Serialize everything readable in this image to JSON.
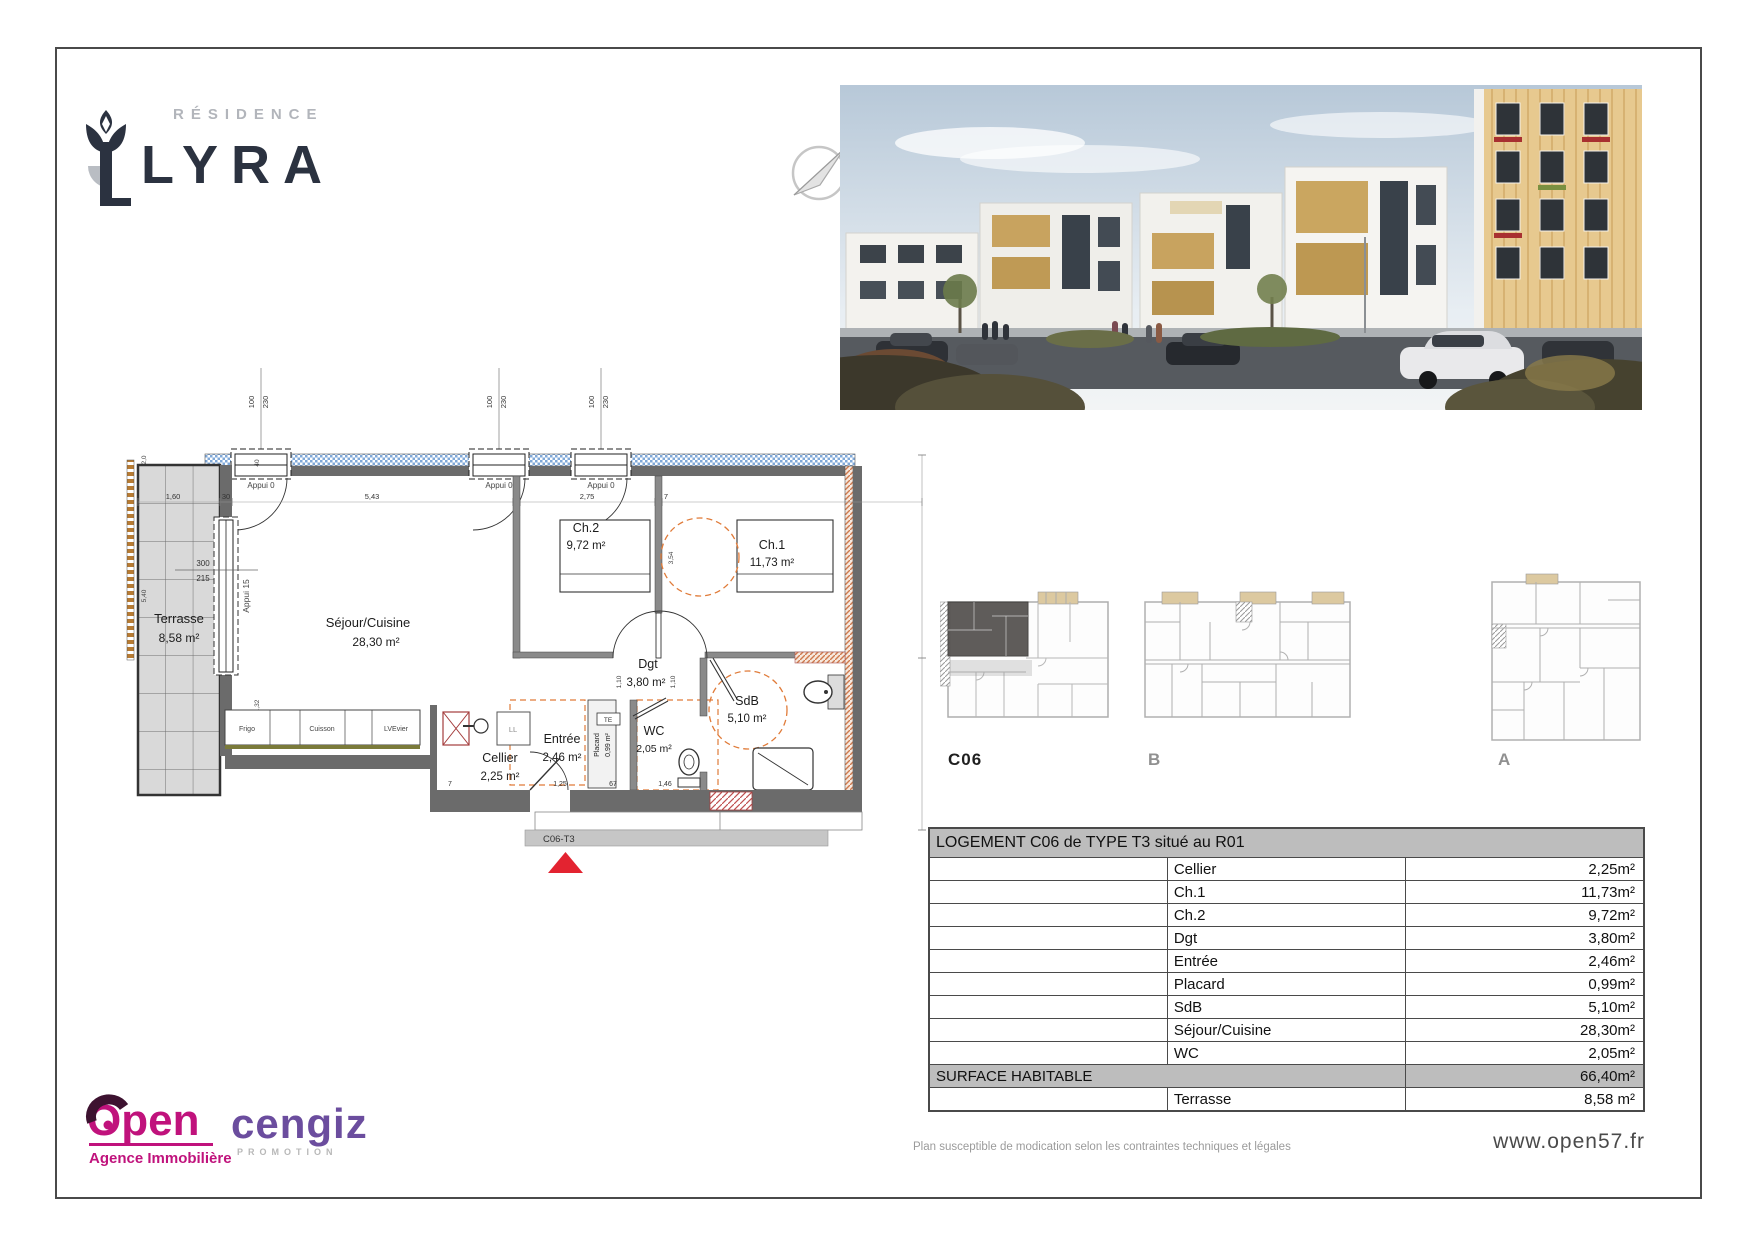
{
  "brand": {
    "residence_label": "RÉSIDENCE",
    "name": "LYRA"
  },
  "plan": {
    "unit_label": "C06-T3",
    "rooms": {
      "terrasse": {
        "name": "Terrasse",
        "area": "8,58 m²"
      },
      "sejour": {
        "name": "Séjour/Cuisine",
        "area": "28,30 m²"
      },
      "ch2": {
        "name": "Ch.2",
        "area": "9,72 m²"
      },
      "ch1": {
        "name": "Ch.1",
        "area": "11,73 m²"
      },
      "dgt": {
        "name": "Dgt",
        "area": "3,80 m²"
      },
      "sdb": {
        "name": "SdB",
        "area": "5,10 m²"
      },
      "wc": {
        "name": "WC",
        "area": "2,05 m²"
      },
      "entree": {
        "name": "Entrée",
        "area": "2,46 m²"
      },
      "cellier": {
        "name": "Cellier",
        "area": "2,25 m²"
      },
      "placard": {
        "name": "Placard",
        "area": "0,99 m²"
      }
    },
    "labels": {
      "appui0": "Appui 0",
      "appui15": "Appui 15",
      "frigo": "Frigo",
      "cuisson": "Cuisson",
      "evier": "LVEvier",
      "ll": "LL",
      "te": "TE"
    },
    "dims": {
      "w100": "100",
      "h230": "230",
      "d300": "300",
      "d215": "215",
      "t160": "1,60",
      "t30": "30",
      "t543": "5,43",
      "t275": "2,75",
      "t7": "7",
      "v354": "3,54",
      "v110": "1,10",
      "v40": "40",
      "v20": "2,0",
      "v540": "5,40",
      "v132": "1,32",
      "b125": "1,25",
      "b67": "67",
      "b146": "1,46"
    }
  },
  "mini_plans": {
    "labels": [
      "C06",
      "B",
      "A"
    ]
  },
  "table": {
    "title": "LOGEMENT C06 de TYPE T3 situé au R01",
    "rows": [
      {
        "label": "Cellier",
        "value": "2,25m²"
      },
      {
        "label": "Ch.1",
        "value": "11,73m²"
      },
      {
        "label": "Ch.2",
        "value": "9,72m²"
      },
      {
        "label": "Dgt",
        "value": "3,80m²"
      },
      {
        "label": "Entrée",
        "value": "2,46m²"
      },
      {
        "label": "Placard",
        "value": "0,99m²"
      },
      {
        "label": "SdB",
        "value": "5,10m²"
      },
      {
        "label": "Séjour/Cuisine",
        "value": "28,30m²"
      },
      {
        "label": "WC",
        "value": "2,05m²"
      }
    ],
    "surface": {
      "label": "SURFACE HABITABLE",
      "value": "66,40m²"
    },
    "annex": {
      "label": "Terrasse",
      "value": "8,58 m²"
    }
  },
  "logos": {
    "open": {
      "name": "Open",
      "tagline": "Agence Immobilière"
    },
    "cengiz": {
      "name": "cengiz",
      "tagline": "PROMOTION"
    }
  },
  "footer": {
    "disclaimer": "Plan susceptible de modication selon les contraintes techniques et légales",
    "website": "www.open57.fr"
  },
  "colors": {
    "accent_magenta": "#c0127c",
    "accent_purple": "#6b4d9e",
    "navy": "#2b3240",
    "table_header_bg": "#bdbdbd",
    "wall": "#6b6b6b",
    "hatch_blue": "#7fa8d9",
    "dash_orange": "#e07b39",
    "triangle_red": "#e32330"
  }
}
